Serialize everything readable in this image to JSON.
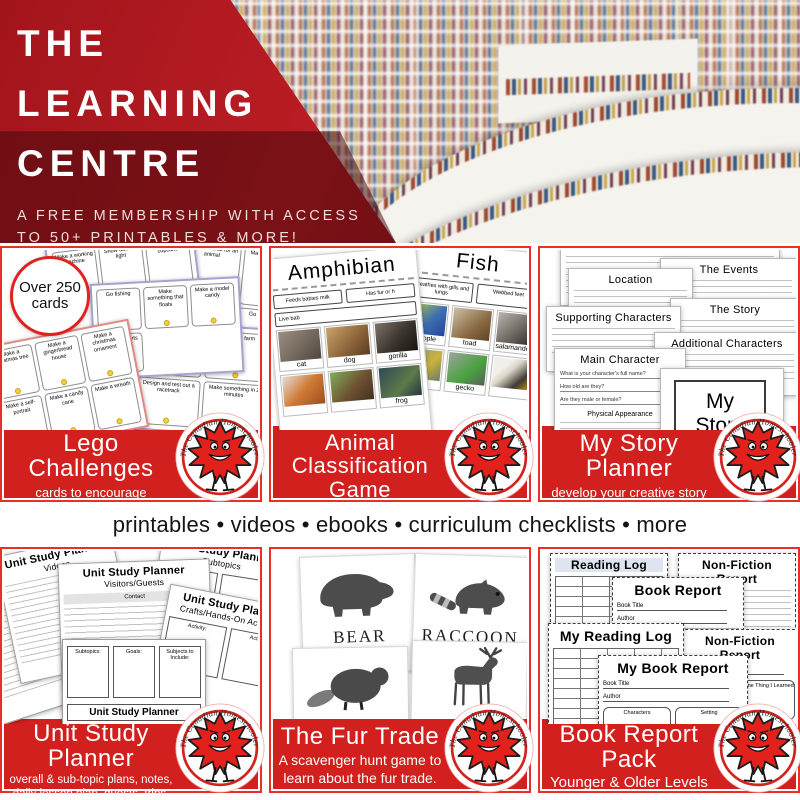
{
  "hero": {
    "title_lines": [
      "THE",
      "LEARNING",
      "CENTRE"
    ],
    "subtitle_lines": [
      "A FREE MEMBERSHIP WITH ACCESS",
      "TO 50+ PRINTABLES & MORE!"
    ]
  },
  "divider_text": "printables • videos • ebooks • curriculum checklists • more",
  "brand": {
    "name": "The Canadian Homeschooler"
  },
  "colors": {
    "hero_red": "#a2151c",
    "card_red": "#d2201f",
    "leaf_red": "#e2201c",
    "border_red": "#ea2e28"
  },
  "cards": {
    "lego": {
      "title": "Lego Challenges",
      "subtitle_lines": [
        "cards to encourage",
        "creativity"
      ],
      "sticker": "Over 250 cards",
      "prompts": [
        "Make a working machine",
        "Make a habitat for an animal",
        "Make a restaurant",
        "Go fishing",
        "Make something that floats",
        "Make a model candy",
        "Show dark vs light",
        "Make a sports stadium",
        "Make a snowman",
        "Go to the farm",
        "Make a christmas tree",
        "Make a gingerbread house",
        "Make a christmas ornament",
        "Make a candy cane",
        "Make a wreath",
        "Design and test out a racetrack",
        "Make something in 2 minutes",
        "Make a self-portrait",
        "Make a cupcake",
        "Make a way to carry an egg"
      ]
    },
    "animal": {
      "title": "Animal Classification Game",
      "page_left": "Amphibian",
      "page_right": "Fish",
      "traits": [
        "Feeds babies milk",
        "Has fur or h",
        "Breathes with gills and lungs",
        "Webbed feet",
        "Live bab"
      ],
      "labels": {
        "cat": "cat",
        "dog": "dog",
        "gorilla": "gorilla",
        "frog": "frog",
        "people": "people",
        "toad": "toad",
        "salamander": "salamander",
        "gecko": "gecko"
      }
    },
    "story": {
      "title": "My Story Planner",
      "subtitle_lines": [
        "develop your creative story",
        "through a series of questions & prompts"
      ],
      "pages": [
        "Location",
        "The Events",
        "The Story",
        "Supporting Characters",
        "Additional Characters",
        "Main Character"
      ],
      "cover": "My Story Planner",
      "questions": [
        "What is your character's full name?",
        "How old are they?",
        "Are they male or female?"
      ],
      "section": "Physical Appearance"
    },
    "unit": {
      "title": "Unit Study Planner",
      "subtitle_lines": [
        "overall & sub-topic plans, notes,",
        "daily lesson plan, guests, trips, videos,",
        "books, crafts, and websites."
      ],
      "page_title": "Unit Study Planner",
      "pages": [
        "Videos",
        "Subtopics",
        "Visitors/Guests",
        "Crafts/Hands-On Activities"
      ],
      "boxes": [
        "Subtopics:",
        "Goals:",
        "Subjects to Include:"
      ],
      "labels": {
        "contact": "Contact",
        "date": "Date",
        "activity": "Activity:"
      }
    },
    "fur": {
      "title": "The Fur Trade",
      "subtitle_lines": [
        "A scavenger hunt game to",
        "learn about the fur trade."
      ],
      "animals": [
        "BEAR",
        "RACCOON",
        "BEAVER",
        "DEER"
      ],
      "need_label": "need",
      "note": "3 deer = 1 beaver"
    },
    "book": {
      "title": "Book Report Pack",
      "subtitle_lines": [
        "Younger & Older Levels",
        "Fiction/Non-Fiction/Reading Logs"
      ],
      "pages": [
        "Reading Log",
        "Non-Fiction Report",
        "Book Report",
        "My Reading Log",
        "Non-Fiction Report",
        "My Book Report"
      ],
      "fields": {
        "book_title": "Book Title",
        "author": "Author",
        "characters": "Characters",
        "setting": "Setting",
        "one_thing": "One Thing I Learned"
      }
    }
  }
}
